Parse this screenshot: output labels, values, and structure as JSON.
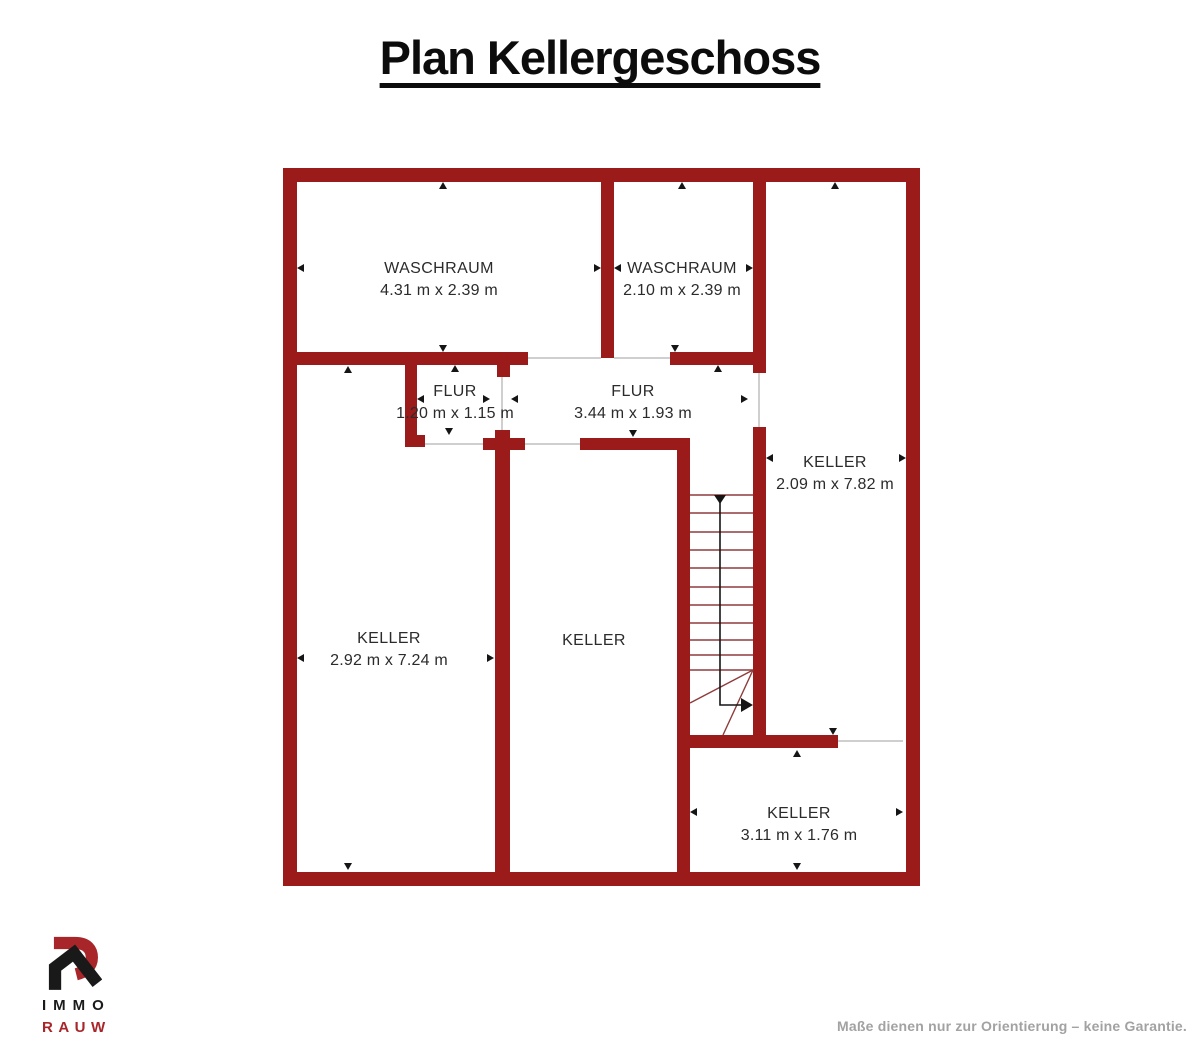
{
  "title": "Plan Kellergeschoss",
  "rooms": [
    {
      "name": "WASCHRAUM",
      "dims": "4.31 m x 2.39 m"
    },
    {
      "name": "WASCHRAUM",
      "dims": "2.10 m x 2.39 m"
    },
    {
      "name": "FLUR",
      "dims": "1.20 m x 1.15 m"
    },
    {
      "name": "FLUR",
      "dims": "3.44 m x 1.93 m"
    },
    {
      "name": "KELLER",
      "dims": "2.09 m x 7.82 m"
    },
    {
      "name": "KELLER",
      "dims": "2.92 m x 7.24 m"
    },
    {
      "name": "KELLER",
      "dims": ""
    },
    {
      "name": "KELLER",
      "dims": "3.11 m x 1.76 m"
    }
  ],
  "logo": {
    "line1": "IMMO",
    "line2": "RAUW"
  },
  "footer": "Maße dienen nur zur Orientierung – keine Garantie.",
  "colors": {
    "wall_red": "#9b1b1b",
    "stair_tread_red": "#8e3b3b",
    "logo_red": "#a8262a",
    "label_text": "#2b2b2b",
    "footer_gray": "#a2a2a2"
  }
}
